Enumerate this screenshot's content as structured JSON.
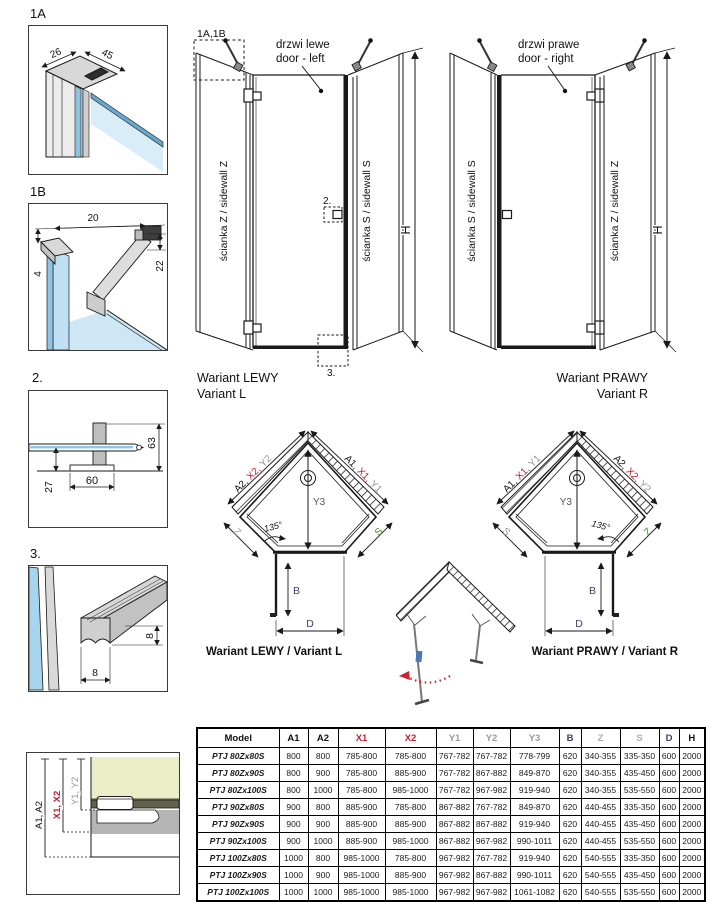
{
  "colors": {
    "line": "#1a1a1a",
    "red": "#c01f2f",
    "gray_label": "#979797",
    "green_label": "#3f8f28",
    "navy": "#3c3c6e",
    "zs_header": "#a9b3a5",
    "glass": "#8ec7e6",
    "glass_light": "#d6ecf8",
    "wall_fill": "#e9eec6"
  },
  "details": {
    "d1a": {
      "label": "1A",
      "dim_depth": "26",
      "dim_width": "45"
    },
    "d1b": {
      "label": "1B",
      "dim_top": "20",
      "dim_left": "4",
      "dim_right": "22"
    },
    "d2": {
      "label": "2.",
      "dim_height": "63",
      "dim_offset": "27",
      "dim_base": "60"
    },
    "d3": {
      "label": "3.",
      "dim_height": "8",
      "dim_width": "8"
    },
    "wall": {
      "dim_a": "A1, A2",
      "dim_x": "X1, X2",
      "dim_y": "Y1, Y2"
    }
  },
  "elevation_left": {
    "ref_label": "1A,1B",
    "door_pl": "drzwi lewe",
    "door_en": "door - left",
    "panel_left": "ścianka Z / sidewall Z",
    "panel_right": "ścianka S / sidewall S",
    "height": "H",
    "marker_2": "2.",
    "marker_3": "3.",
    "caption1": "Wariant LEWY",
    "caption2": "Variant L"
  },
  "elevation_right": {
    "door_pl": "drzwi prawe",
    "door_en": "door - right",
    "panel_left": "ścianka S / sidewall S",
    "panel_right": "ścianka Z / sidewall Z",
    "height": "H",
    "caption1": "Wariant PRAWY",
    "caption2": "Variant R"
  },
  "plan_left": {
    "edge_left_a": "A2,",
    "edge_left_x": "X2,",
    "edge_left_y": "Y2",
    "edge_right_a": "A1,",
    "edge_right_x": "X1,",
    "edge_right_y": "Y1",
    "y3": "Y3",
    "angle": "135°",
    "z": "Z",
    "s": "S",
    "b": "B",
    "d": "D",
    "caption": "Wariant LEWY / Variant L"
  },
  "plan_right": {
    "edge_left_a": "A1,",
    "edge_left_x": "X1,",
    "edge_left_y": "Y1",
    "edge_right_a": "A2,",
    "edge_right_x": "X2,",
    "edge_right_y": "Y2",
    "y3": "Y3",
    "angle": "135°",
    "z": "Z",
    "s": "S",
    "b": "B",
    "d": "D",
    "caption": "Wariant PRAWY / Variant R"
  },
  "table": {
    "headers": [
      {
        "label": "Model",
        "color": "#111111"
      },
      {
        "label": "A1",
        "color": "#111111"
      },
      {
        "label": "A2",
        "color": "#111111"
      },
      {
        "label": "X1",
        "color": "#c01f2f"
      },
      {
        "label": "X2",
        "color": "#c01f2f"
      },
      {
        "label": "Y1",
        "color": "#9a9a9a"
      },
      {
        "label": "Y2",
        "color": "#9a9a9a"
      },
      {
        "label": "Y3",
        "color": "#9a9a9a"
      },
      {
        "label": "B",
        "color": "#3c3c6e"
      },
      {
        "label": "Z",
        "color": "#a9b3a5"
      },
      {
        "label": "S",
        "color": "#a9b3a5"
      },
      {
        "label": "D",
        "color": "#3c3c6e"
      },
      {
        "label": "H",
        "color": "#111111"
      }
    ],
    "rows": [
      {
        "model": "PTJ 80Zx80S",
        "values": [
          "800",
          "800",
          "785-800",
          "785-800",
          "767-782",
          "767-782",
          "778-799",
          "620",
          "340-355",
          "335-350",
          "600",
          "2000"
        ]
      },
      {
        "model": "PTJ 80Zx90S",
        "values": [
          "800",
          "900",
          "785-800",
          "885-900",
          "767-782",
          "867-882",
          "849-870",
          "620",
          "340-355",
          "435-450",
          "600",
          "2000"
        ]
      },
      {
        "model": "PTJ 80Zx100S",
        "values": [
          "800",
          "1000",
          "785-800",
          "985-1000",
          "767-782",
          "967-982",
          "919-940",
          "620",
          "340-355",
          "535-550",
          "600",
          "2000"
        ]
      },
      {
        "model": "PTJ 90Zx80S",
        "values": [
          "900",
          "800",
          "885-900",
          "785-800",
          "867-882",
          "767-782",
          "849-870",
          "620",
          "440-455",
          "335-350",
          "600",
          "2000"
        ]
      },
      {
        "model": "PTJ 90Zx90S",
        "values": [
          "900",
          "900",
          "885-900",
          "885-900",
          "867-882",
          "867-882",
          "919-940",
          "620",
          "440-455",
          "435-450",
          "600",
          "2000"
        ]
      },
      {
        "model": "PTJ 90Zx100S",
        "values": [
          "900",
          "1000",
          "885-900",
          "985-1000",
          "867-882",
          "967-982",
          "990-1011",
          "620",
          "440-455",
          "535-550",
          "600",
          "2000"
        ]
      },
      {
        "model": "PTJ 100Zx80S",
        "values": [
          "1000",
          "800",
          "985-1000",
          "785-800",
          "967-982",
          "767-782",
          "919-940",
          "620",
          "540-555",
          "335-350",
          "600",
          "2000"
        ]
      },
      {
        "model": "PTJ 100Zx90S",
        "values": [
          "1000",
          "900",
          "985-1000",
          "885-900",
          "967-982",
          "867-882",
          "990-1011",
          "620",
          "540-555",
          "435-450",
          "600",
          "2000"
        ]
      },
      {
        "model": "PTJ 100Zx100S",
        "values": [
          "1000",
          "1000",
          "985-1000",
          "985-1000",
          "967-982",
          "967-982",
          "1061-1082",
          "620",
          "540-555",
          "535-550",
          "600",
          "2000"
        ]
      }
    ]
  }
}
